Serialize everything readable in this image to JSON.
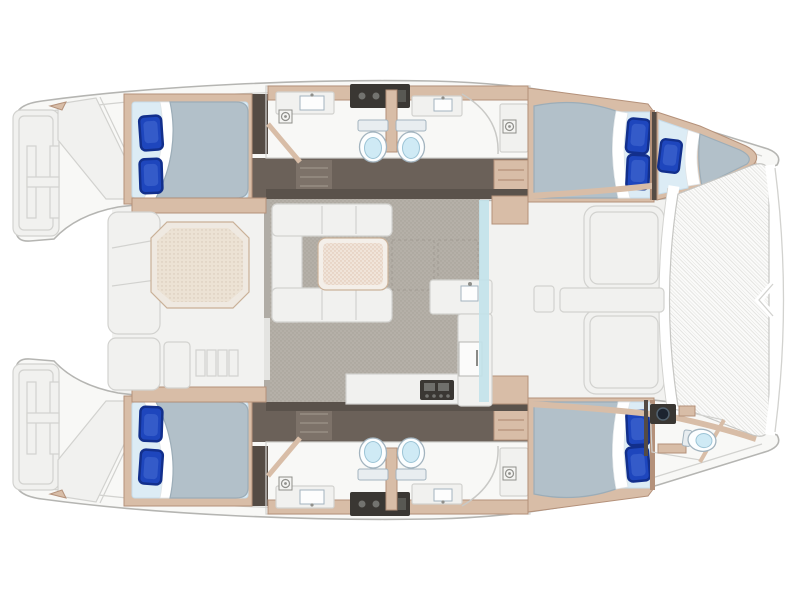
{
  "meta": {
    "kind": "yacht-deck-plan-illustration",
    "vessel": "sailing-catamaran",
    "view": "overhead-floor-plan",
    "orientation": {
      "bow": "right",
      "stern": "left"
    },
    "canvas": {
      "width": 800,
      "height": 600
    },
    "visible_text": "none"
  },
  "colors": {
    "pure_white": "#ffffff",
    "deck_white": "#f8f8f6",
    "deck_light": "#f1f1ef",
    "hull_stroke": "#b5b5b2",
    "line_light": "#d2d2cf",
    "wood_tan": "#d8bda7",
    "wood_dark": "#b4917a",
    "brown_floor": "#6b6159",
    "brown_dark": "#544b44",
    "brown_step": "#7d7269",
    "floor_gray": "#b5b0a8",
    "bed_sheet": "#dcecf5",
    "duvet": "#b2c0c9",
    "duvet_edge": "#9cadb8",
    "pillow": "#1e46bd",
    "pillow_dark": "#122f8c",
    "pillow_light": "#4a6fd6",
    "toilet_stroke": "#a3b4bf",
    "toilet_seat": "#cfeaf5",
    "table_beige": "#f0e4d9",
    "window_cyan": "#c2e2ea",
    "appliance": "#3a3733",
    "mesh_line": "#e4e4e1"
  },
  "layout": {
    "stern_left": {
      "swim_platforms": 2,
      "boarding_ladders": 2,
      "transom_step_panels": true
    },
    "cockpit_aft": {
      "table_shape": "octagonal",
      "chaise_lounge": 1,
      "bench_cushions": 2,
      "companionway_steps": 1,
      "cleats": 2
    },
    "salon": {
      "sofa": "u-shaped",
      "dining_table": 1,
      "galley_counter": "L-shaped",
      "galley_sink": 1,
      "stove": 1,
      "forward_door": 1,
      "forward_window": "cyan-glazing"
    },
    "port_hull_top": {
      "aft_cabin_double_bed": 1,
      "aft_pillows": 2,
      "heads": 2,
      "toilets": 2,
      "sinks": 2,
      "washer_icons": 2,
      "corridor": "dark-floor-with-steps",
      "forward_cabin_double_bed": 1,
      "forward_pillows": 2,
      "forward_single_berth": 1,
      "berth_pillows": 1
    },
    "starboard_hull_bottom": {
      "aft_cabin_double_bed": 1,
      "aft_pillows": 2,
      "heads": 2,
      "toilets": 2,
      "sinks": 2,
      "washer_icons": 2,
      "corridor": "dark-floor-with-steps",
      "forward_cabin_double_bed": 1,
      "forward_pillows": 2,
      "bow_head_toilet": 1,
      "bow_head_vanity": 1
    },
    "foredeck": {
      "lounge_pads_tan": 2,
      "seat_panels": 2,
      "deck_box": 1,
      "center_walkway": 1
    },
    "bow_right": {
      "trampoline": "mesh-netting",
      "forward_crossbeam": true,
      "bow_beam": true,
      "bridle_chevron": true
    }
  },
  "totals": {
    "double_beds": 4,
    "single_berths": 1,
    "toilets": 5,
    "sinks": 6,
    "blue_pillows": 9,
    "tables": 2,
    "showers": 4
  }
}
